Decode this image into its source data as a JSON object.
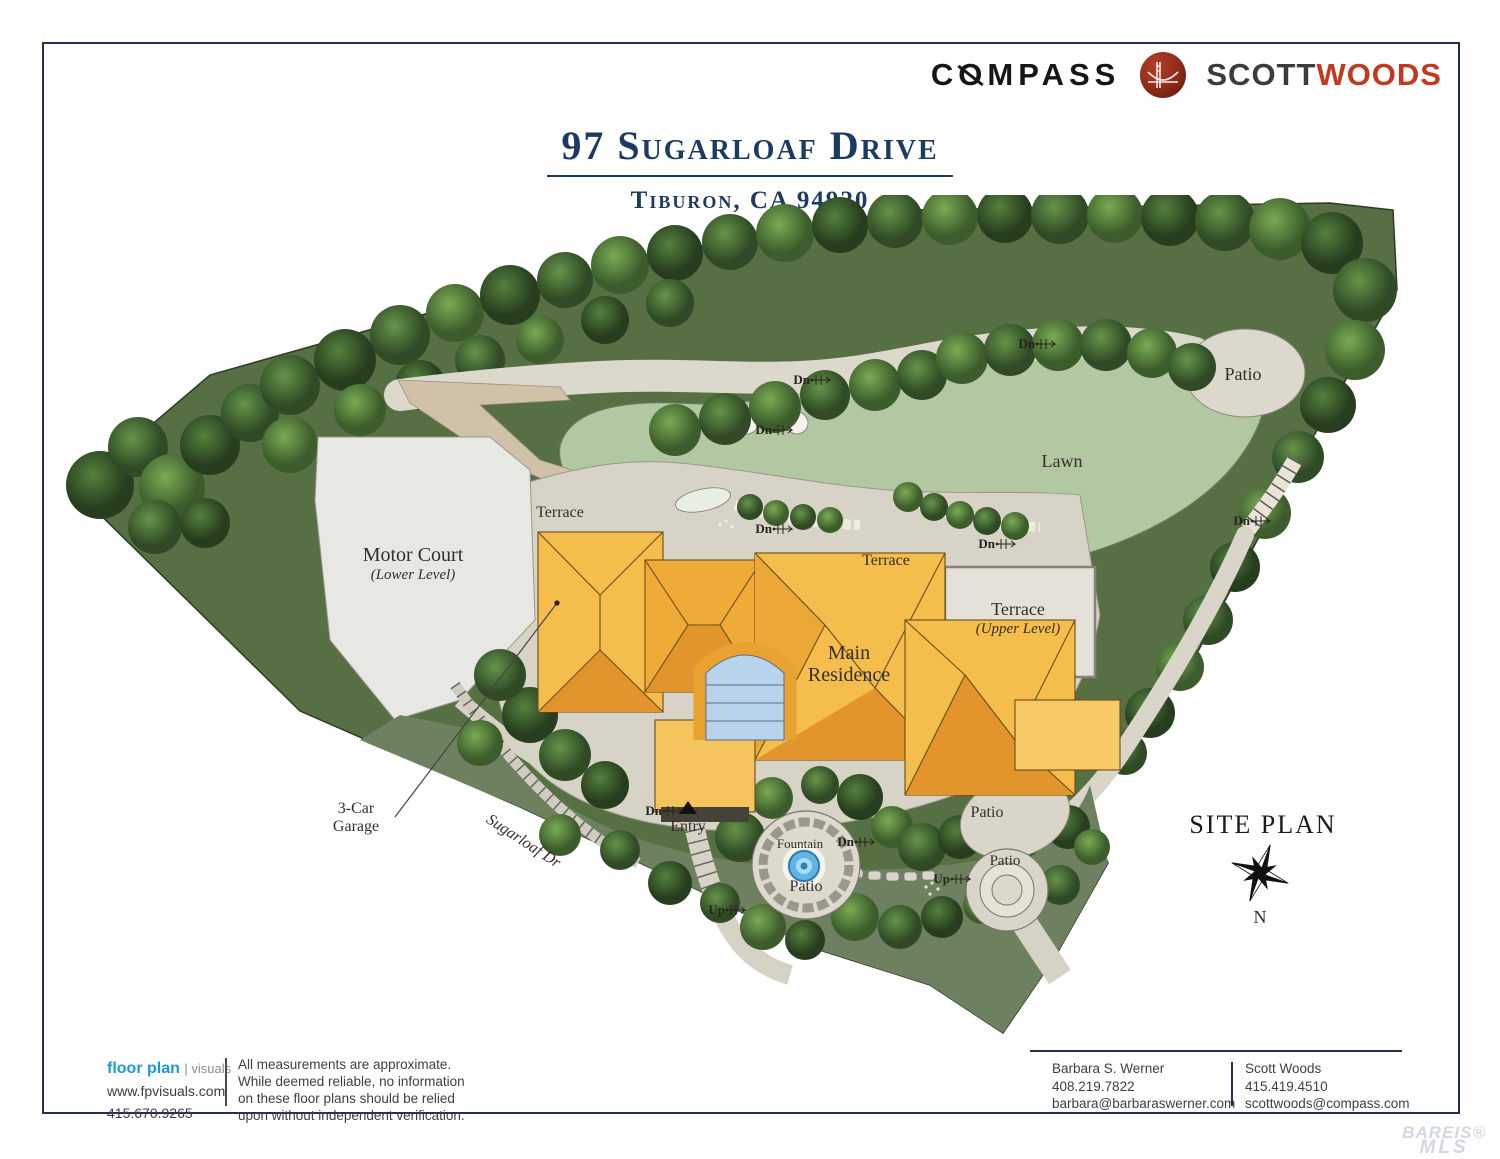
{
  "brand": {
    "compass_pre": "C",
    "compass_o": "O",
    "compass_post": "MPASS",
    "scott": "SCOTT",
    "woods": "WOODS",
    "woods_color": "#c23a1d"
  },
  "header": {
    "title": "97 Sugarloaf Drive",
    "subtitle": "Tiburon, CA 94920",
    "accent_color": "#1d3a60"
  },
  "plan": {
    "title": "SITE PLAN",
    "north": "N",
    "labels": {
      "patio_top": "Patio",
      "lawn": "Lawn",
      "terrace_left": "Terrace",
      "terrace_center": "Terrace",
      "terrace_upper": "Terrace",
      "terrace_upper_sub": "(Upper Level)",
      "motor_court": "Motor Court",
      "motor_court_sub": "(Lower Level)",
      "residence_line1": "Main",
      "residence_line2": "Residence",
      "garage_line1": "3-Car",
      "garage_line2": "Garage",
      "street": "Sugarloaf Dr",
      "entry": "Entry",
      "fountain": "Fountain",
      "fountain_patio": "Patio",
      "patio_mid": "Patio",
      "patio_lower": "Patio"
    },
    "stair_markers": [
      {
        "text": "Dn",
        "x": 975,
        "y": 153
      },
      {
        "text": "Dn",
        "x": 750,
        "y": 189
      },
      {
        "text": "Dn",
        "x": 712,
        "y": 239
      },
      {
        "text": "Dn",
        "x": 712,
        "y": 338
      },
      {
        "text": "Dn",
        "x": 935,
        "y": 353
      },
      {
        "text": "Dn",
        "x": 1190,
        "y": 330
      },
      {
        "text": "Dn",
        "x": 602,
        "y": 620
      },
      {
        "text": "Dn",
        "x": 794,
        "y": 651
      },
      {
        "text": "Up",
        "x": 890,
        "y": 688
      },
      {
        "text": "Up",
        "x": 665,
        "y": 719
      }
    ]
  },
  "footer": {
    "vendor": {
      "name_bold": "floor plan",
      "name_light": "visuals",
      "website": "www.fpvisuals.com",
      "phone": "415.670.9265",
      "brand_color": "#1d9bd1"
    },
    "disclaimer": [
      "All measurements are approximate.",
      "While deemed reliable, no information",
      "on these floor plans should be relied",
      "upon without independent verification."
    ],
    "contact1": {
      "name": "Barbara S. Werner",
      "phone": "408.219.7822",
      "email": "barbara@barbaraswerner.com"
    },
    "contact2": {
      "name": "Scott Woods",
      "phone": "415.419.4510",
      "email": "scottwoods@compass.com"
    }
  },
  "watermark": {
    "line1": "BAREIS",
    "reg": "®",
    "line2": "MLS"
  }
}
